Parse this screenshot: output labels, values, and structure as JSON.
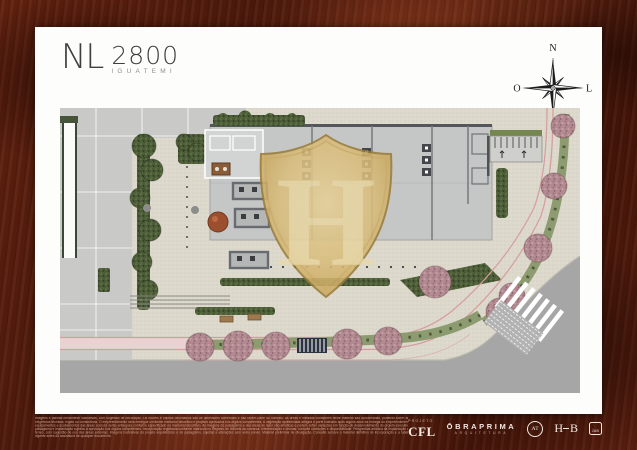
{
  "logo": {
    "brand": "NL",
    "number": "2800",
    "subtitle": "IGUATEMI"
  },
  "compass": {
    "north": "N",
    "east": "L",
    "south": "S",
    "west": "O"
  },
  "watermark": {
    "letter": "H"
  },
  "footer": {
    "disclaimer_lines": [
      "Imagens e plantas meramente ilustrativas, com sugestão de decoração. Os móveis e objetos decorativos são de dimensões comerciais e não fazem parte do contrato. As áreas e medidas constantes neste material são aproximadas, podendo sofrer alterações por exigências técnicas, legais ou construtivas.",
      "O empreendimento será entregue conforme memorial descritivo e projetos aprovados nos órgãos competentes. A vegetação apresentada atingirá o porte ilustrado após alguns anos da entrega do empreendimento. Materiais, equipamentos e acabamentos das áreas comuns serão entregues conforme especificado no memorial descritivo.",
      "As imagens do paisagismo e das áreas de lazer são artísticas e podem sofrer variações em função do desenvolvimento do projeto executivo. Projeto de paisagismo e implantação sujeitos à aprovação nos órgãos competentes. Incorporação registrada conforme matrícula no Registro de Imóveis da comarca.",
      "Intermediação e vendas: consulte condições e disponibilidade. Perspectiva artística da implantação do pavimento térreo, com sugestão de uso das áreas externas. Imagens ilustrativas do projeto arquitetônico e de paisagismo, sujeitas a alterações sem aviso prévio.",
      "Material preliminar de divulgação. Consulte sempre o material definitivo de incorporação e a tabela de vendas vigente antes da assinatura de qualquer documento."
    ],
    "credits": {
      "projeto_label": "PROJETO",
      "cfl": "CFL",
      "obraprima": "ŌBRAPRIMA",
      "obraprima_sub": "ARQUITETURA",
      "at_monogram": "AT",
      "hb_left": "H",
      "hb_right": "B",
      "jab_monogram": "JAB"
    }
  },
  "colors": {
    "frame_red": "#5d1f10",
    "page_white": "#fdfdfc",
    "shield_gold": "#d4b472",
    "plan_gray": "#c9c9c7",
    "building_gray": "#c5c7c6",
    "hedge_green": "#4c5c39",
    "median_green": "#8d9b70",
    "tree_pink": "#b28b92",
    "street_gray": "#a6a6a7",
    "curb_pink": "#d79c9c",
    "logo_ink": "#3f3f3f"
  }
}
